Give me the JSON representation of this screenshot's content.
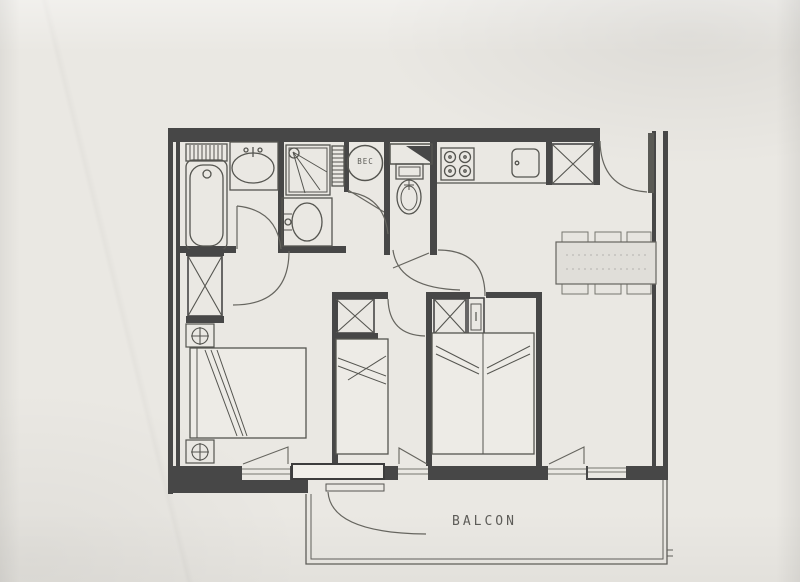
{
  "plan": {
    "labels": {
      "balcony": "BALCON",
      "water_heater": "BEC"
    },
    "colors": {
      "paper": "#eae8e3",
      "wall": "#474747",
      "fixture_line": "#555550",
      "door_line": "#66655f",
      "balcony_line": "#5f5e59",
      "furniture_fill": "#edebe6",
      "table_fill": "#e0ded9",
      "label_text": "#5d5c58"
    },
    "fixtures": [
      "bathtub",
      "radiator",
      "vanity-basin",
      "shower",
      "towel-radiator",
      "water-heater",
      "hand-basin",
      "toilet",
      "duct-shaft",
      "stove-4-burners",
      "kitchen-sink",
      "wardrobe",
      "small-cabinet",
      "double-bed",
      "twin-bed",
      "nightstand-lamp",
      "dining-table",
      "chair",
      "entrance-door",
      "interior-door",
      "window",
      "balcony-door",
      "balcony"
    ]
  }
}
